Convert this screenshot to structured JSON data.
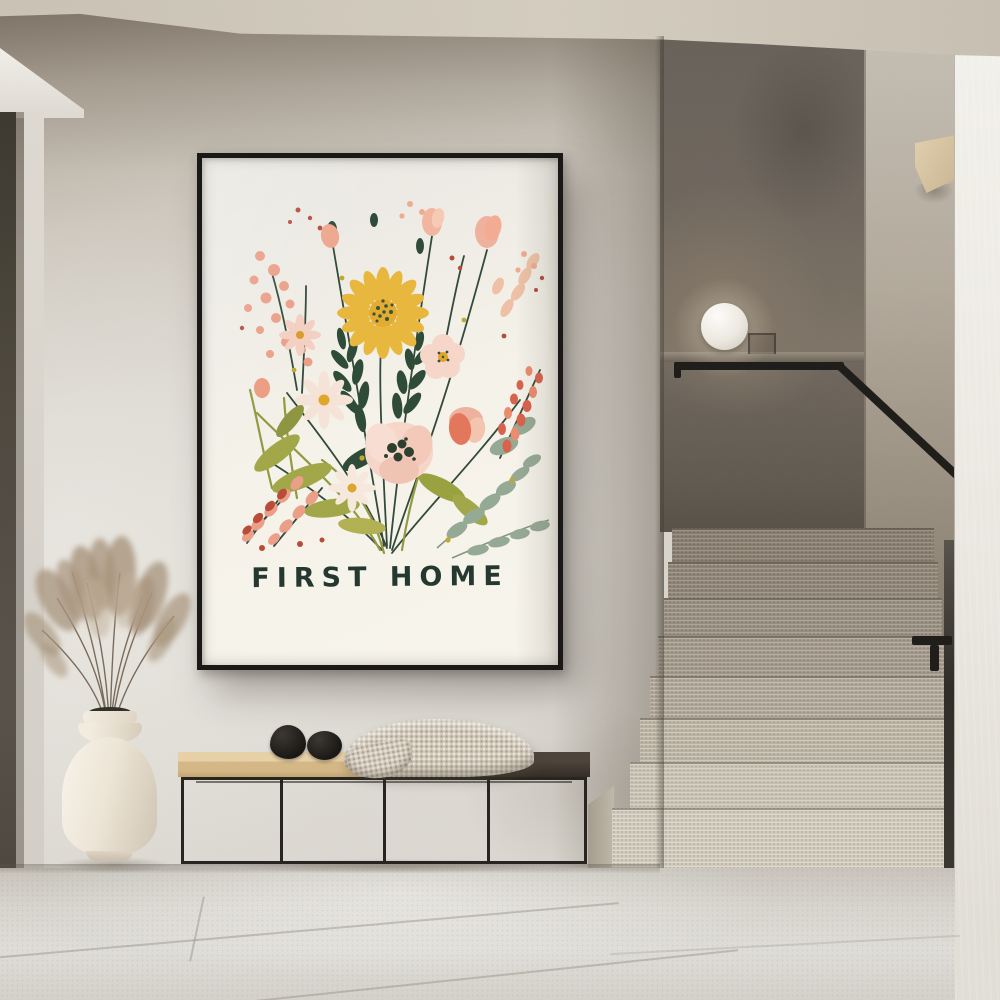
{
  "poster": {
    "title": "FIRST HOME",
    "artwork": "watercolor wildflower bouquet illustration"
  },
  "objects": {
    "poster": "black framed botanical print on wall",
    "lamp": "white sphere lamp on stair landing",
    "vase": "cream ceramic vase with dried pampas grass",
    "bench": "black metal bench with two-tone wood seat",
    "decor_stones": "two black pebble sculptures on bench",
    "throw": "beige knit throw blanket draped on bench",
    "stairs": "terrazzo staircase with black metal handrail",
    "visible_step_count": 8
  },
  "palette": {
    "wall-main": "#d7d3cb",
    "wall-shadow": "#8e8478",
    "ceiling": "#cbc4b6",
    "stairwell-dark": "#6a635a",
    "stair-wall-right": "#a89e91",
    "white-wall": "#efede7",
    "floor": "#d6d3cc",
    "frame-black": "#191816",
    "paper": "#f5f2ea",
    "text-green": "#24372f",
    "rail-black": "#1f1d1a",
    "wood-bench": "#d9bc8e",
    "bench-dark": "#38312a",
    "metal-frame": "#262320",
    "vase-cream": "#efe9dc",
    "pampas": "#a6927a",
    "blanket": "#d2c9ba",
    "pebble": "#211e1b",
    "wedge-wood": "#d8c5a4",
    "lamp-white": "#f7f5f0",
    "flower-yellow": "#e8b63c",
    "flower-darkgreen": "#2f4a38",
    "flower-olive": "#9aa144",
    "flower-sage": "#93a893",
    "flower-blush": "#f5d6c8",
    "flower-pink": "#eeb09c",
    "flower-coral": "#e2755a",
    "flower-red": "#bb4a38"
  }
}
